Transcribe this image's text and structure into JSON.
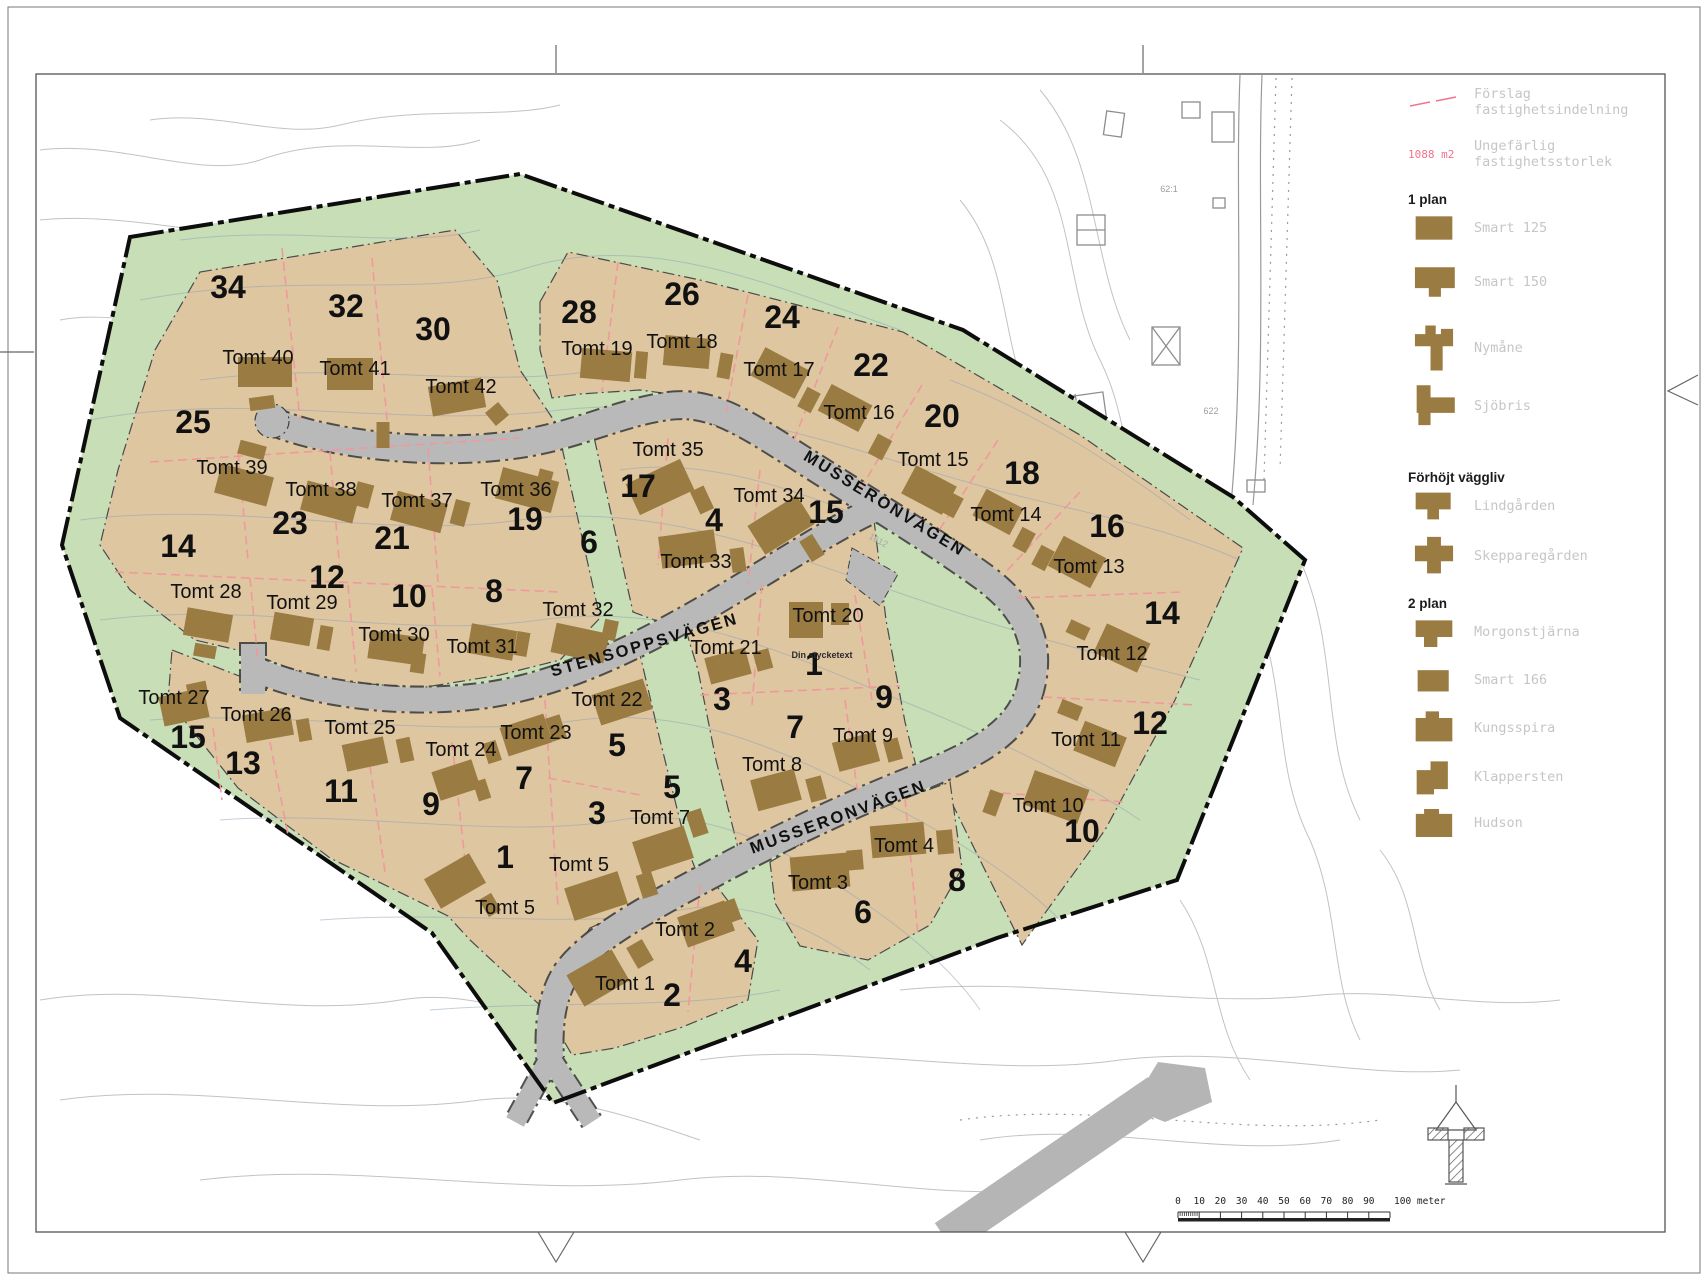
{
  "palette": {
    "site_green": "#c8deb6",
    "plot_tan": "#dec6a1",
    "road_gray": "#b9b9b9",
    "house_brown": "#9a7b41",
    "divider_pink": "#f0999d",
    "boundary_black": "#0d0d0d",
    "contour_blue": "#8fa0b5",
    "legend_gray": "#c6c6c6",
    "pink_text": "#f2738c"
  },
  "map": {
    "streets": {
      "musseronvagen_upper": "MUSSERONVÄGEN",
      "stensoppsvagen": "STENSOPPSVÄGEN",
      "musseronvagen_lower": "MUSSERONVÄGEN"
    },
    "area_numbers": [
      {
        "n": "34",
        "x": 228,
        "y": 298
      },
      {
        "n": "32",
        "x": 346,
        "y": 317
      },
      {
        "n": "30",
        "x": 433,
        "y": 340
      },
      {
        "n": "25",
        "x": 193,
        "y": 433
      },
      {
        "n": "28",
        "x": 579,
        "y": 323
      },
      {
        "n": "26",
        "x": 682,
        "y": 305
      },
      {
        "n": "24",
        "x": 782,
        "y": 328
      },
      {
        "n": "22",
        "x": 871,
        "y": 376
      },
      {
        "n": "20",
        "x": 942,
        "y": 427
      },
      {
        "n": "18",
        "x": 1022,
        "y": 484
      },
      {
        "n": "16",
        "x": 1107,
        "y": 537
      },
      {
        "n": "14",
        "x": 1162,
        "y": 624
      },
      {
        "n": "12",
        "x": 1150,
        "y": 734
      },
      {
        "n": "10",
        "x": 1082,
        "y": 842
      },
      {
        "n": "23",
        "x": 290,
        "y": 534
      },
      {
        "n": "21",
        "x": 392,
        "y": 549
      },
      {
        "n": "19",
        "x": 525,
        "y": 530
      },
      {
        "n": "17",
        "x": 638,
        "y": 497
      },
      {
        "n": "15",
        "x": 826,
        "y": 523
      },
      {
        "n": "14",
        "x": 178,
        "y": 557
      },
      {
        "n": "12",
        "x": 327,
        "y": 588
      },
      {
        "n": "10",
        "x": 409,
        "y": 607
      },
      {
        "n": "8",
        "x": 494,
        "y": 602
      },
      {
        "n": "6",
        "x": 589,
        "y": 553
      },
      {
        "n": "4",
        "x": 714,
        "y": 531
      },
      {
        "n": "15",
        "x": 188,
        "y": 748
      },
      {
        "n": "13",
        "x": 243,
        "y": 774
      },
      {
        "n": "11",
        "x": 341,
        "y": 802
      },
      {
        "n": "9",
        "x": 431,
        "y": 815
      },
      {
        "n": "7",
        "x": 524,
        "y": 789
      },
      {
        "n": "5",
        "x": 617,
        "y": 756
      },
      {
        "n": "3",
        "x": 597,
        "y": 824
      },
      {
        "n": "5",
        "x": 672,
        "y": 798
      },
      {
        "n": "1",
        "x": 505,
        "y": 868
      },
      {
        "n": "3",
        "x": 722,
        "y": 710
      },
      {
        "n": "1",
        "x": 814,
        "y": 675
      },
      {
        "n": "9",
        "x": 884,
        "y": 708
      },
      {
        "n": "7",
        "x": 795,
        "y": 738
      },
      {
        "n": "2",
        "x": 672,
        "y": 1006
      },
      {
        "n": "4",
        "x": 743,
        "y": 972
      },
      {
        "n": "6",
        "x": 863,
        "y": 923
      },
      {
        "n": "8",
        "x": 957,
        "y": 891
      }
    ],
    "tomt_labels": [
      {
        "t": "Tomt 40",
        "x": 258,
        "y": 364
      },
      {
        "t": "Tomt 41",
        "x": 355,
        "y": 375
      },
      {
        "t": "Tomt 42",
        "x": 461,
        "y": 393
      },
      {
        "t": "Tomt 39",
        "x": 232,
        "y": 474
      },
      {
        "t": "Tomt 38",
        "x": 321,
        "y": 496
      },
      {
        "t": "Tomt 37",
        "x": 417,
        "y": 507
      },
      {
        "t": "Tomt 36",
        "x": 516,
        "y": 496
      },
      {
        "t": "Tomt 35",
        "x": 668,
        "y": 456
      },
      {
        "t": "Tomt 34",
        "x": 769,
        "y": 502
      },
      {
        "t": "Tomt 33",
        "x": 696,
        "y": 568
      },
      {
        "t": "Tomt 32",
        "x": 578,
        "y": 616
      },
      {
        "t": "Tomt 31",
        "x": 482,
        "y": 653
      },
      {
        "t": "Tomt 30",
        "x": 394,
        "y": 641
      },
      {
        "t": "Tomt 29",
        "x": 302,
        "y": 609
      },
      {
        "t": "Tomt 28",
        "x": 206,
        "y": 598
      },
      {
        "t": "Tomt 27",
        "x": 174,
        "y": 704
      },
      {
        "t": "Tomt 26",
        "x": 256,
        "y": 721
      },
      {
        "t": "Tomt 25",
        "x": 360,
        "y": 734
      },
      {
        "t": "Tomt 24",
        "x": 461,
        "y": 756
      },
      {
        "t": "Tomt 23",
        "x": 536,
        "y": 739
      },
      {
        "t": "Tomt 22",
        "x": 607,
        "y": 706
      },
      {
        "t": "Tomt 21",
        "x": 726,
        "y": 654
      },
      {
        "t": "Tomt 20",
        "x": 828,
        "y": 622
      },
      {
        "t": "Tomt 19",
        "x": 597,
        "y": 355
      },
      {
        "t": "Tomt 18",
        "x": 682,
        "y": 348
      },
      {
        "t": "Tomt 17",
        "x": 779,
        "y": 376
      },
      {
        "t": "Tomt 16",
        "x": 859,
        "y": 419
      },
      {
        "t": "Tomt 15",
        "x": 933,
        "y": 466
      },
      {
        "t": "Tomt 14",
        "x": 1006,
        "y": 521
      },
      {
        "t": "Tomt 13",
        "x": 1089,
        "y": 573
      },
      {
        "t": "Tomt 12",
        "x": 1112,
        "y": 660
      },
      {
        "t": "Tomt 11",
        "x": 1086,
        "y": 746
      },
      {
        "t": "Tomt 10",
        "x": 1048,
        "y": 812
      },
      {
        "t": "Tomt 9",
        "x": 863,
        "y": 742
      },
      {
        "t": "Tomt 8",
        "x": 772,
        "y": 771
      },
      {
        "t": "Tomt 7",
        "x": 660,
        "y": 824
      },
      {
        "t": "Tomt 5",
        "x": 579,
        "y": 871
      },
      {
        "t": "Tomt 5",
        "x": 505,
        "y": 914
      },
      {
        "t": "Tomt 4",
        "x": 904,
        "y": 852
      },
      {
        "t": "Tomt 3",
        "x": 818,
        "y": 889
      },
      {
        "t": "Tomt 2",
        "x": 685,
        "y": 936
      },
      {
        "t": "Tomt 1",
        "x": 625,
        "y": 990
      }
    ],
    "annotations": [
      {
        "t": "Din stycketext",
        "x": 822,
        "y": 658,
        "s": 9,
        "c": "#2b2b2b",
        "r": 0,
        "b": 1
      },
      {
        "t": "1612",
        "x": 877,
        "y": 543,
        "s": 9,
        "c": "#a8a8a8",
        "r": 28,
        "b": 0
      },
      {
        "t": "62:1",
        "x": 1169,
        "y": 192,
        "s": 9,
        "c": "#9d9d9d",
        "r": 0,
        "b": 0
      },
      {
        "t": "622",
        "x": 1211,
        "y": 414,
        "s": 9,
        "c": "#9d9d9d",
        "r": 0,
        "b": 0
      }
    ],
    "houses": [
      [
        265,
        372,
        54,
        30,
        0
      ],
      [
        262,
        403,
        25,
        13,
        -8
      ],
      [
        350,
        374,
        46,
        32,
        0
      ],
      [
        383,
        435,
        13,
        26,
        0
      ],
      [
        457,
        397,
        54,
        30,
        -10
      ],
      [
        497,
        414,
        17,
        17,
        -40
      ],
      [
        244,
        485,
        54,
        30,
        15
      ],
      [
        252,
        450,
        27,
        14,
        15
      ],
      [
        330,
        502,
        54,
        30,
        15
      ],
      [
        363,
        495,
        17,
        24,
        15
      ],
      [
        419,
        512,
        52,
        30,
        15
      ],
      [
        460,
        513,
        15,
        25,
        15
      ],
      [
        527,
        490,
        58,
        32,
        15
      ],
      [
        545,
        477,
        14,
        14,
        15
      ],
      [
        660,
        487,
        60,
        34,
        -25
      ],
      [
        702,
        500,
        15,
        25,
        -25
      ],
      [
        781,
        525,
        58,
        34,
        -32
      ],
      [
        812,
        548,
        15,
        24,
        -32
      ],
      [
        688,
        549,
        56,
        32,
        -8
      ],
      [
        738,
        560,
        14,
        24,
        -8
      ],
      [
        606,
        365,
        50,
        30,
        5
      ],
      [
        641,
        365,
        12,
        27,
        5
      ],
      [
        687,
        352,
        46,
        30,
        5
      ],
      [
        725,
        366,
        13,
        25,
        10
      ],
      [
        780,
        373,
        50,
        32,
        28
      ],
      [
        809,
        400,
        15,
        22,
        28
      ],
      [
        845,
        408,
        46,
        30,
        28
      ],
      [
        880,
        447,
        16,
        22,
        28
      ],
      [
        929,
        490,
        46,
        32,
        28
      ],
      [
        952,
        505,
        15,
        22,
        28
      ],
      [
        998,
        512,
        42,
        30,
        28
      ],
      [
        1024,
        540,
        15,
        22,
        28
      ],
      [
        1077,
        562,
        48,
        34,
        28
      ],
      [
        1043,
        558,
        15,
        22,
        28
      ],
      [
        1122,
        648,
        48,
        32,
        25
      ],
      [
        1078,
        630,
        21,
        14,
        25
      ],
      [
        1100,
        744,
        45,
        32,
        22
      ],
      [
        1070,
        710,
        22,
        15,
        22
      ],
      [
        1056,
        797,
        58,
        36,
        20
      ],
      [
        993,
        803,
        14,
        24,
        20
      ],
      [
        806,
        620,
        34,
        36,
        0
      ],
      [
        840,
        614,
        18,
        22,
        0
      ],
      [
        728,
        666,
        42,
        27,
        -15
      ],
      [
        763,
        660,
        16,
        20,
        -15
      ],
      [
        856,
        752,
        42,
        30,
        -15
      ],
      [
        893,
        750,
        15,
        22,
        -15
      ],
      [
        776,
        790,
        45,
        32,
        -15
      ],
      [
        816,
        789,
        16,
        24,
        -15
      ],
      [
        622,
        702,
        54,
        32,
        -18
      ],
      [
        556,
        728,
        15,
        24,
        -18
      ],
      [
        526,
        735,
        46,
        30,
        -18
      ],
      [
        492,
        752,
        14,
        21,
        -18
      ],
      [
        456,
        780,
        42,
        30,
        -18
      ],
      [
        482,
        790,
        13,
        20,
        -18
      ],
      [
        365,
        754,
        42,
        27,
        -12
      ],
      [
        405,
        750,
        14,
        24,
        -12
      ],
      [
        268,
        725,
        48,
        28,
        -10
      ],
      [
        304,
        730,
        13,
        22,
        -10
      ],
      [
        184,
        707,
        46,
        30,
        -12
      ],
      [
        197,
        689,
        20,
        13,
        -12
      ],
      [
        208,
        625,
        46,
        28,
        10
      ],
      [
        205,
        651,
        22,
        13,
        10
      ],
      [
        292,
        629,
        40,
        28,
        10
      ],
      [
        325,
        638,
        13,
        24,
        10
      ],
      [
        396,
        648,
        54,
        28,
        8
      ],
      [
        418,
        663,
        14,
        20,
        8
      ],
      [
        492,
        642,
        46,
        30,
        10
      ],
      [
        522,
        644,
        13,
        24,
        10
      ],
      [
        580,
        643,
        54,
        30,
        12
      ],
      [
        610,
        630,
        14,
        20,
        12
      ],
      [
        596,
        896,
        56,
        34,
        -18
      ],
      [
        647,
        885,
        16,
        24,
        -18
      ],
      [
        455,
        881,
        52,
        34,
        -30
      ],
      [
        490,
        905,
        14,
        20,
        -30
      ],
      [
        663,
        850,
        54,
        34,
        -18
      ],
      [
        697,
        823,
        16,
        26,
        -18
      ],
      [
        598,
        978,
        52,
        36,
        -30
      ],
      [
        640,
        954,
        18,
        24,
        -30
      ],
      [
        706,
        924,
        50,
        32,
        -20
      ],
      [
        731,
        911,
        15,
        22,
        -20
      ],
      [
        820,
        872,
        58,
        34,
        -5
      ],
      [
        855,
        860,
        16,
        20,
        -5
      ],
      [
        898,
        840,
        54,
        32,
        -5
      ],
      [
        945,
        842,
        16,
        24,
        -5
      ]
    ],
    "dividers": [
      [
        282,
        248,
        300,
        420
      ],
      [
        372,
        258,
        388,
        430
      ],
      [
        150,
        462,
        520,
        438
      ],
      [
        238,
        452,
        248,
        560
      ],
      [
        330,
        452,
        340,
        572
      ],
      [
        428,
        448,
        438,
        582
      ],
      [
        115,
        572,
        560,
        592
      ],
      [
        250,
        578,
        258,
        662
      ],
      [
        348,
        585,
        356,
        672
      ],
      [
        432,
        588,
        440,
        676
      ],
      [
        618,
        262,
        602,
        392
      ],
      [
        748,
        295,
        726,
        412
      ],
      [
        838,
        327,
        794,
        440
      ],
      [
        922,
        385,
        860,
        490
      ],
      [
        998,
        440,
        934,
        538
      ],
      [
        1080,
        492,
        1004,
        574
      ],
      [
        1017,
        598,
        1183,
        592
      ],
      [
        1043,
        697,
        1195,
        705
      ],
      [
        988,
        792,
        1125,
        802
      ],
      [
        213,
        728,
        222,
        800
      ],
      [
        270,
        742,
        288,
        835
      ],
      [
        368,
        752,
        385,
        872
      ],
      [
        452,
        742,
        468,
        888
      ],
      [
        545,
        700,
        558,
        908
      ],
      [
        548,
        778,
        640,
        795
      ],
      [
        762,
        585,
        752,
        705
      ],
      [
        855,
        595,
        872,
        700
      ],
      [
        700,
        695,
        900,
        686
      ],
      [
        845,
        700,
        858,
        795
      ],
      [
        700,
        885,
        688,
        1012
      ],
      [
        905,
        798,
        918,
        935
      ],
      [
        668,
        438,
        658,
        565
      ],
      [
        760,
        470,
        748,
        585
      ]
    ]
  },
  "legend": {
    "proposal_line_label": "Förslag\nfastighetsindelning",
    "area_size_sample": "1088 m2",
    "area_size_label": "Ungefärlig\nfastighetsstorlek",
    "sections": [
      {
        "title": "1 plan"
      },
      {
        "title": "Förhöjt väggliv"
      },
      {
        "title": "2 plan"
      }
    ],
    "house_types": [
      {
        "name": "smart-125",
        "label": "Smart 125"
      },
      {
        "name": "smart-150",
        "label": "Smart 150"
      },
      {
        "name": "nymane",
        "label": "Nymåne"
      },
      {
        "name": "sjobris",
        "label": "Sjöbris"
      },
      {
        "name": "lindgarden",
        "label": "Lindgården"
      },
      {
        "name": "skepparegarden",
        "label": "Skepparegården"
      },
      {
        "name": "morgonstjarna",
        "label": "Morgonstjärna"
      },
      {
        "name": "smart-166",
        "label": "Smart 166"
      },
      {
        "name": "kungsspira",
        "label": "Kungsspira"
      },
      {
        "name": "klappersten",
        "label": "Klappersten"
      },
      {
        "name": "hudson",
        "label": "Hudson"
      }
    ]
  },
  "scalebar": {
    "ticks": [
      "0",
      "10",
      "20",
      "30",
      "40",
      "50",
      "60",
      "70",
      "80",
      "90"
    ],
    "end_label": "100 meter"
  }
}
